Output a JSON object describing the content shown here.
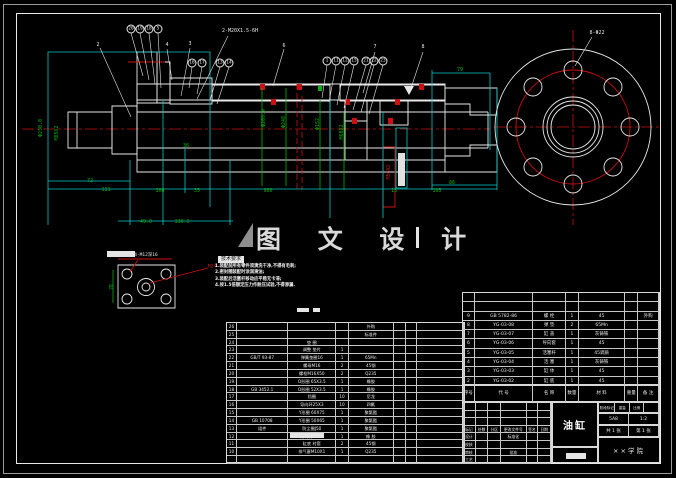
{
  "watermark": {
    "text": "图 文 设 计"
  },
  "tech_notes": {
    "title": "技术要求",
    "lines": [
      "1.装配前所有零件须清洗干净,不得有毛刺;",
      "2.密封圈装配时涂润滑油;",
      "3.装配后活塞杆移动应平稳无卡滞;",
      "4.按1.5倍额定压力作耐压试验,不得渗漏."
    ]
  },
  "annotations": [
    {
      "t": "Φ230.0",
      "x": 41,
      "y": 128,
      "r": -90
    },
    {
      "t": "M85X2",
      "x": 57,
      "y": 133,
      "r": -90
    },
    {
      "t": "72",
      "x": 90,
      "y": 181
    },
    {
      "t": "111",
      "x": 106,
      "y": 190
    },
    {
      "t": "106",
      "x": 160,
      "y": 191
    },
    {
      "t": "35",
      "x": 197,
      "y": 191
    },
    {
      "t": "900",
      "x": 268,
      "y": 191
    },
    {
      "t": "13",
      "x": 394,
      "y": 191
    },
    {
      "t": "105",
      "x": 437,
      "y": 191
    },
    {
      "t": "86",
      "x": 452,
      "y": 183
    },
    {
      "t": "79",
      "x": 460,
      "y": 70
    },
    {
      "t": "49.0",
      "x": 146,
      "y": 222
    },
    {
      "t": "130.6",
      "x": 182,
      "y": 222
    },
    {
      "t": "36",
      "x": 186,
      "y": 146
    },
    {
      "t": "Φ209.4",
      "x": 264,
      "y": 118,
      "r": -90
    },
    {
      "t": "Φ248",
      "x": 284,
      "y": 122,
      "r": -90
    },
    {
      "t": "Φ152",
      "x": 318,
      "y": 124,
      "r": -90
    },
    {
      "t": "M60X2",
      "x": 342,
      "y": 132,
      "r": -90
    },
    {
      "t": "M56X2",
      "x": 389,
      "y": 172,
      "r": -90,
      "c": "#cc2020"
    },
    {
      "t": "2-M20X1.5-6H",
      "x": 240,
      "y": 31,
      "c": "#e6e6e6",
      "n": "thread-spec-label"
    },
    {
      "t": "8-Φ22",
      "x": 597,
      "y": 33,
      "c": "#e6e6e6",
      "n": "bolt-hole-label"
    },
    {
      "t": "4-M12深16",
      "x": 146,
      "y": 255,
      "c": "#e6e6e6",
      "s": 4.5,
      "n": "detail-hole-label"
    },
    {
      "t": "M24",
      "x": 212,
      "y": 267,
      "c": "#cc2020",
      "s": 4.5,
      "n": "detail-thread-label"
    },
    {
      "t": "70",
      "x": 112,
      "y": 287,
      "r": -90,
      "s": 4.5
    },
    {
      "t": "2",
      "x": 98,
      "y": 45,
      "c": "#e6e6e6",
      "n": "part-callout"
    },
    {
      "t": "4",
      "x": 167,
      "y": 45,
      "c": "#e6e6e6",
      "n": "part-callout"
    },
    {
      "t": "3",
      "x": 190,
      "y": 44,
      "c": "#e6e6e6",
      "n": "part-callout"
    },
    {
      "t": "6",
      "x": 284,
      "y": 46,
      "c": "#e6e6e6",
      "n": "part-callout"
    },
    {
      "t": "7",
      "x": 375,
      "y": 47,
      "c": "#e6e6e6",
      "n": "part-callout"
    },
    {
      "t": "8",
      "x": 423,
      "y": 47,
      "c": "#e6e6e6",
      "n": "part-callout"
    }
  ],
  "balloons": [
    {
      "num": "20",
      "x": 131,
      "y": 29
    },
    {
      "num": "19",
      "x": 140,
      "y": 29
    },
    {
      "num": "18",
      "x": 149,
      "y": 29
    },
    {
      "num": "5",
      "x": 158,
      "y": 29
    },
    {
      "num": "16",
      "x": 192,
      "y": 63
    },
    {
      "num": "17",
      "x": 202,
      "y": 63
    },
    {
      "num": "13",
      "x": 220,
      "y": 63
    },
    {
      "num": "14",
      "x": 229,
      "y": 63
    },
    {
      "num": "1",
      "x": 327,
      "y": 61
    },
    {
      "num": "11",
      "x": 336,
      "y": 61
    },
    {
      "num": "12",
      "x": 345,
      "y": 61
    },
    {
      "num": "15",
      "x": 354,
      "y": 61
    },
    {
      "num": "21",
      "x": 366,
      "y": 61
    },
    {
      "num": "22",
      "x": 374,
      "y": 61
    },
    {
      "num": "23",
      "x": 383,
      "y": 61
    }
  ],
  "bom": {
    "rows": [
      [
        "26",
        "",
        "",
        "",
        "外购",
        "",
        "",
        ""
      ],
      [
        "25",
        "",
        "",
        "",
        "标准件",
        "",
        "",
        ""
      ],
      [
        "24",
        "",
        "垫 圈",
        "",
        "",
        "",
        "",
        ""
      ],
      [
        "23",
        "",
        "调整 垫片",
        "1",
        "",
        "",
        "",
        ""
      ],
      [
        "22",
        "GB/T 93-87",
        "弹簧垫圈16",
        "1",
        "65Mn",
        "",
        "",
        ""
      ],
      [
        "21",
        "",
        "螺母M16",
        "2",
        "45钢",
        "",
        "",
        ""
      ],
      [
        "20",
        "",
        "螺栓M16X50",
        "2",
        "Q235",
        "",
        "",
        ""
      ],
      [
        "19",
        "",
        "O形圈 65X3.5",
        "1",
        "橡胶",
        "",
        "",
        ""
      ],
      [
        "18",
        "GB 3452.1",
        "O形圈 52X3.5",
        "1",
        "橡胶",
        "",
        "",
        ""
      ],
      [
        "17",
        "",
        "挡圈",
        "10",
        "尼龙",
        "",
        "",
        ""
      ],
      [
        "16",
        "",
        "导向环25X3",
        "10",
        "四氟",
        "",
        "",
        ""
      ],
      [
        "15",
        "",
        "Y形圈 60X75",
        "1",
        "聚氨酯",
        "",
        "",
        ""
      ],
      [
        "14",
        "GB 10708",
        "Y形圈 50X65",
        "1",
        "聚氨酯",
        "",
        "",
        ""
      ],
      [
        "13",
        "组件",
        "防尘圈J50",
        "1",
        "聚氨酯",
        "",
        "",
        ""
      ],
      [
        "12",
        "",
        "斯特封75X8",
        "1",
        "橡 胶",
        "",
        "",
        ""
      ],
      [
        "11",
        "",
        "缸底 衬套",
        "2",
        "45钢",
        "",
        "",
        ""
      ],
      [
        "10",
        "",
        "排气塞M10X1",
        "1",
        "Q235",
        "",
        "",
        ""
      ],
      [
        "",
        "",
        "",
        "",
        "",
        "",
        "",
        ""
      ]
    ]
  },
  "parts_table": {
    "rows": [
      [
        "",
        "",
        "",
        "",
        "",
        "",
        ""
      ],
      [
        "",
        "",
        "",
        "",
        "",
        "",
        ""
      ],
      [
        "9",
        "GB 5782-86",
        "螺 栓",
        "1",
        "45",
        "",
        "外购"
      ],
      [
        "8",
        "YG-03-08",
        "弹 垫",
        "2",
        "65Mn",
        "",
        ""
      ],
      [
        "7",
        "YG-03-07",
        "缸 盖",
        "1",
        "灰铸铁",
        "",
        ""
      ],
      [
        "6",
        "YG-03-06",
        "导向套",
        "1",
        "45",
        "",
        ""
      ],
      [
        "5",
        "YG-03-05",
        "活塞杆",
        "1",
        "45调质",
        "",
        ""
      ],
      [
        "4",
        "YG-03-04",
        "活 塞",
        "1",
        "灰铸铁",
        "",
        ""
      ],
      [
        "3",
        "YG-03-03",
        "缸 体",
        "1",
        "45",
        "",
        ""
      ],
      [
        "2",
        "YG-03-02",
        "缸 底",
        "1",
        "45",
        "",
        ""
      ]
    ],
    "header_rows": [
      [
        "序号",
        "代 号",
        "名 称",
        "数量",
        "材 料",
        "重量",
        "备 注"
      ]
    ]
  },
  "title_block": {
    "title": "油缸",
    "sig_rows": [
      [
        "",
        "",
        "",
        "",
        "",
        ""
      ],
      [
        "",
        "",
        "",
        "",
        "",
        ""
      ],
      [
        "",
        "",
        "",
        "",
        "",
        ""
      ],
      [
        "标记",
        "处数",
        "分区",
        "更改文件号",
        "签名",
        "日期"
      ],
      [
        "设计",
        "",
        "",
        "标准化",
        "",
        ""
      ],
      [
        "校核",
        "",
        "",
        "",
        "",
        ""
      ],
      [
        "审核",
        "",
        "",
        "批准",
        "",
        ""
      ],
      [
        "工艺",
        "",
        "",
        "",
        "",
        ""
      ]
    ],
    "stage_rows": [
      [
        "阶段标记",
        "重量",
        "比例",
        ""
      ]
    ],
    "scale_rows": [
      [
        "5A8",
        "1:2"
      ]
    ],
    "sheet_rows": [
      [
        "共 1 张",
        "第 1 张"
      ]
    ],
    "org": "××学院"
  },
  "colors": {
    "line": "#e8e8e8",
    "dim_line": "#00c8c8",
    "dim_text": "#00b400",
    "centerline": "#cc1010"
  }
}
